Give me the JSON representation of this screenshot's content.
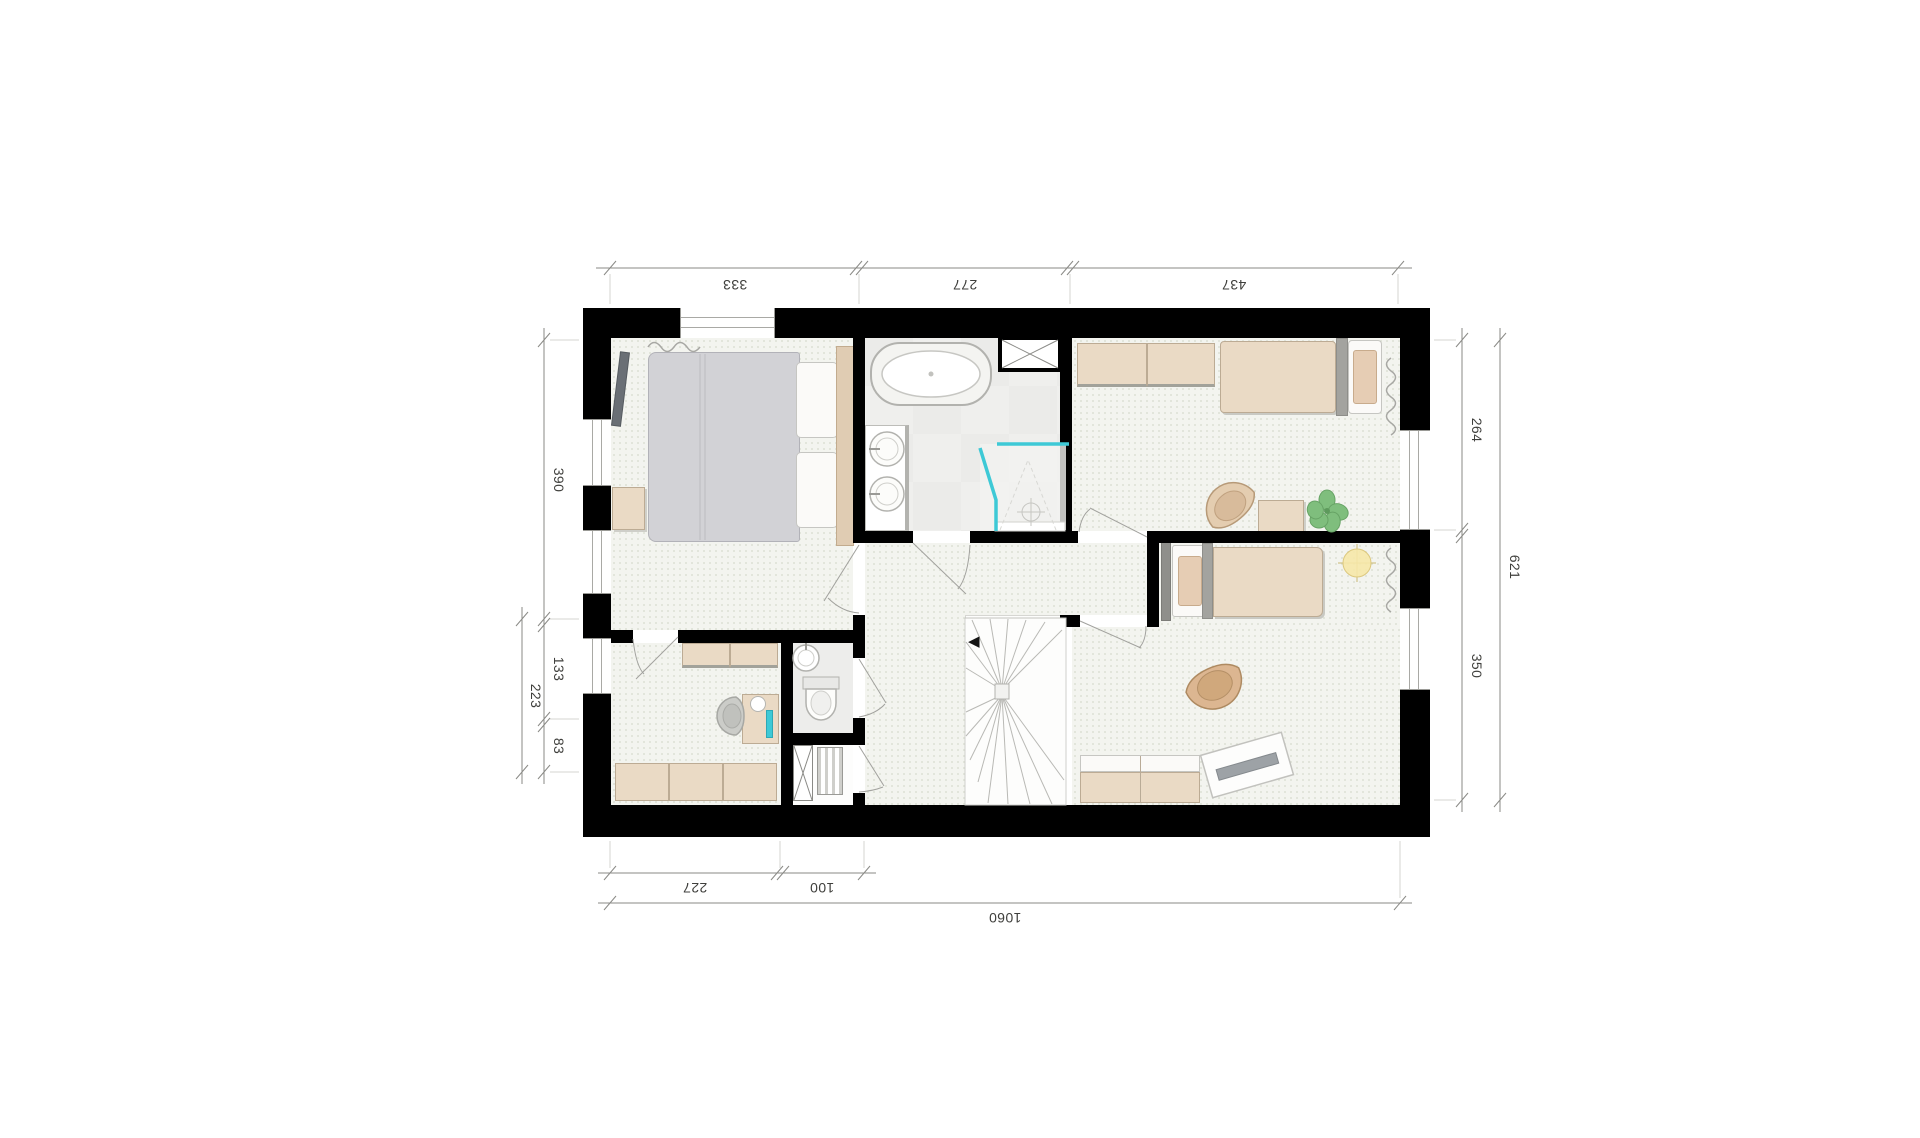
{
  "floorplan": {
    "type": "architectural-floor-plan",
    "dims": {
      "top": [
        "333",
        "277",
        "437"
      ],
      "left": [
        "390",
        "133",
        "83"
      ],
      "left_outer": [
        "223"
      ],
      "right": [
        "264",
        "350"
      ],
      "right_outer": [
        "621"
      ],
      "bottom": [
        "227",
        "100"
      ],
      "bottom_outer": [
        "1060"
      ]
    },
    "icons": {
      "stairs_arrow": "◀"
    },
    "colors": {
      "wall": "#000000",
      "shower_glass": "#3EC9D6",
      "plant_green": "#7FBE7D",
      "night_light": "#F6E8A8",
      "furniture_beige": "#EADAC5",
      "bed_blanket_gray": "#D2D2D6",
      "floor_tint": "#F3F4EF",
      "bathroom_floor": "#EBEBE9",
      "dimension_text": "#3F3F3C"
    }
  }
}
